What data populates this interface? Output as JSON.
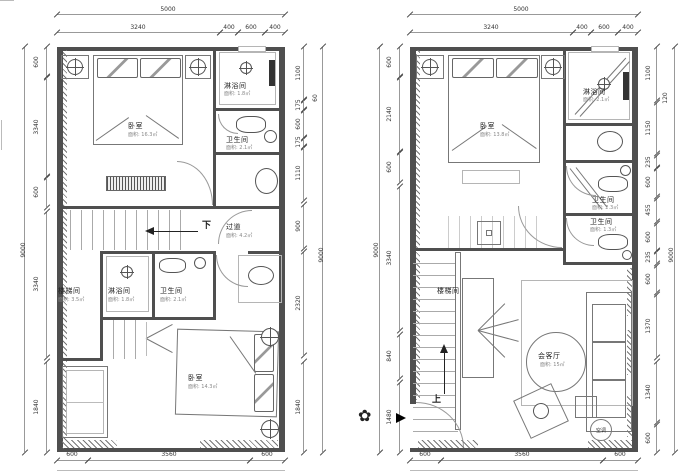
{
  "colors": {
    "wall": "#4f4f4f",
    "line": "#999",
    "dim_text": "#333"
  },
  "annotations": {
    "down": "下",
    "up": "上",
    "ac": "空调"
  },
  "icons": {
    "entrance_plant": "✿"
  },
  "left": {
    "top_overall": "5000",
    "top": [
      "3240",
      "400",
      "600",
      "400"
    ],
    "bottom": [
      "600",
      "3560",
      "600"
    ],
    "left_overall": "9000",
    "left": [
      "600",
      "3340",
      "600",
      "3340",
      "1840"
    ],
    "right_overall": "9000",
    "right": [
      "1100",
      "175",
      "600",
      "175",
      "1110",
      "900",
      "2320",
      "1840"
    ],
    "right_extra": "60",
    "rooms": {
      "bedroom_top": {
        "name": "卧室",
        "area": "面积: 16.3㎡"
      },
      "shower_top": {
        "name": "淋浴间",
        "area": "面积: 1.8㎡"
      },
      "bath_top": {
        "name": "卫生间",
        "area": "面积: 2.1㎡"
      },
      "corridor": {
        "name": "过道",
        "area": "面积: 4.2㎡"
      },
      "stair": {
        "name": "楼梯间",
        "area": "面积: 3.5㎡"
      },
      "shower_mid": {
        "name": "淋浴间",
        "area": "面积: 1.8㎡"
      },
      "bath_mid": {
        "name": "卫生间",
        "area": "面积: 2.1㎡"
      },
      "bedroom_bottom": {
        "name": "卧室",
        "area": "面积: 14.3㎡"
      }
    }
  },
  "right": {
    "top_overall": "5000",
    "top": [
      "3240",
      "400",
      "600",
      "400"
    ],
    "bottom": [
      "600",
      "3560",
      "600"
    ],
    "left_overall": "9000",
    "left": [
      "600",
      "2140",
      "600",
      "3340",
      "840",
      "1480"
    ],
    "right_overall": "9000",
    "right": [
      "1100",
      "1150",
      "235",
      "600",
      "455",
      "600",
      "235",
      "600",
      "1370",
      "1340",
      "600"
    ],
    "right_extra": "120",
    "rooms": {
      "bedroom": {
        "name": "卧室",
        "area": "面积: 13.8㎡"
      },
      "shower": {
        "name": "淋浴间",
        "area": "面积: 2.1㎡"
      },
      "bath1": {
        "name": "卫生间",
        "area": "面积: 2.3㎡"
      },
      "bath2": {
        "name": "卫生间",
        "area": "面积: 1.3㎡"
      },
      "stair": {
        "name": "楼梯间"
      },
      "living": {
        "name": "会客厅",
        "area": "面积: 15㎡"
      }
    }
  }
}
